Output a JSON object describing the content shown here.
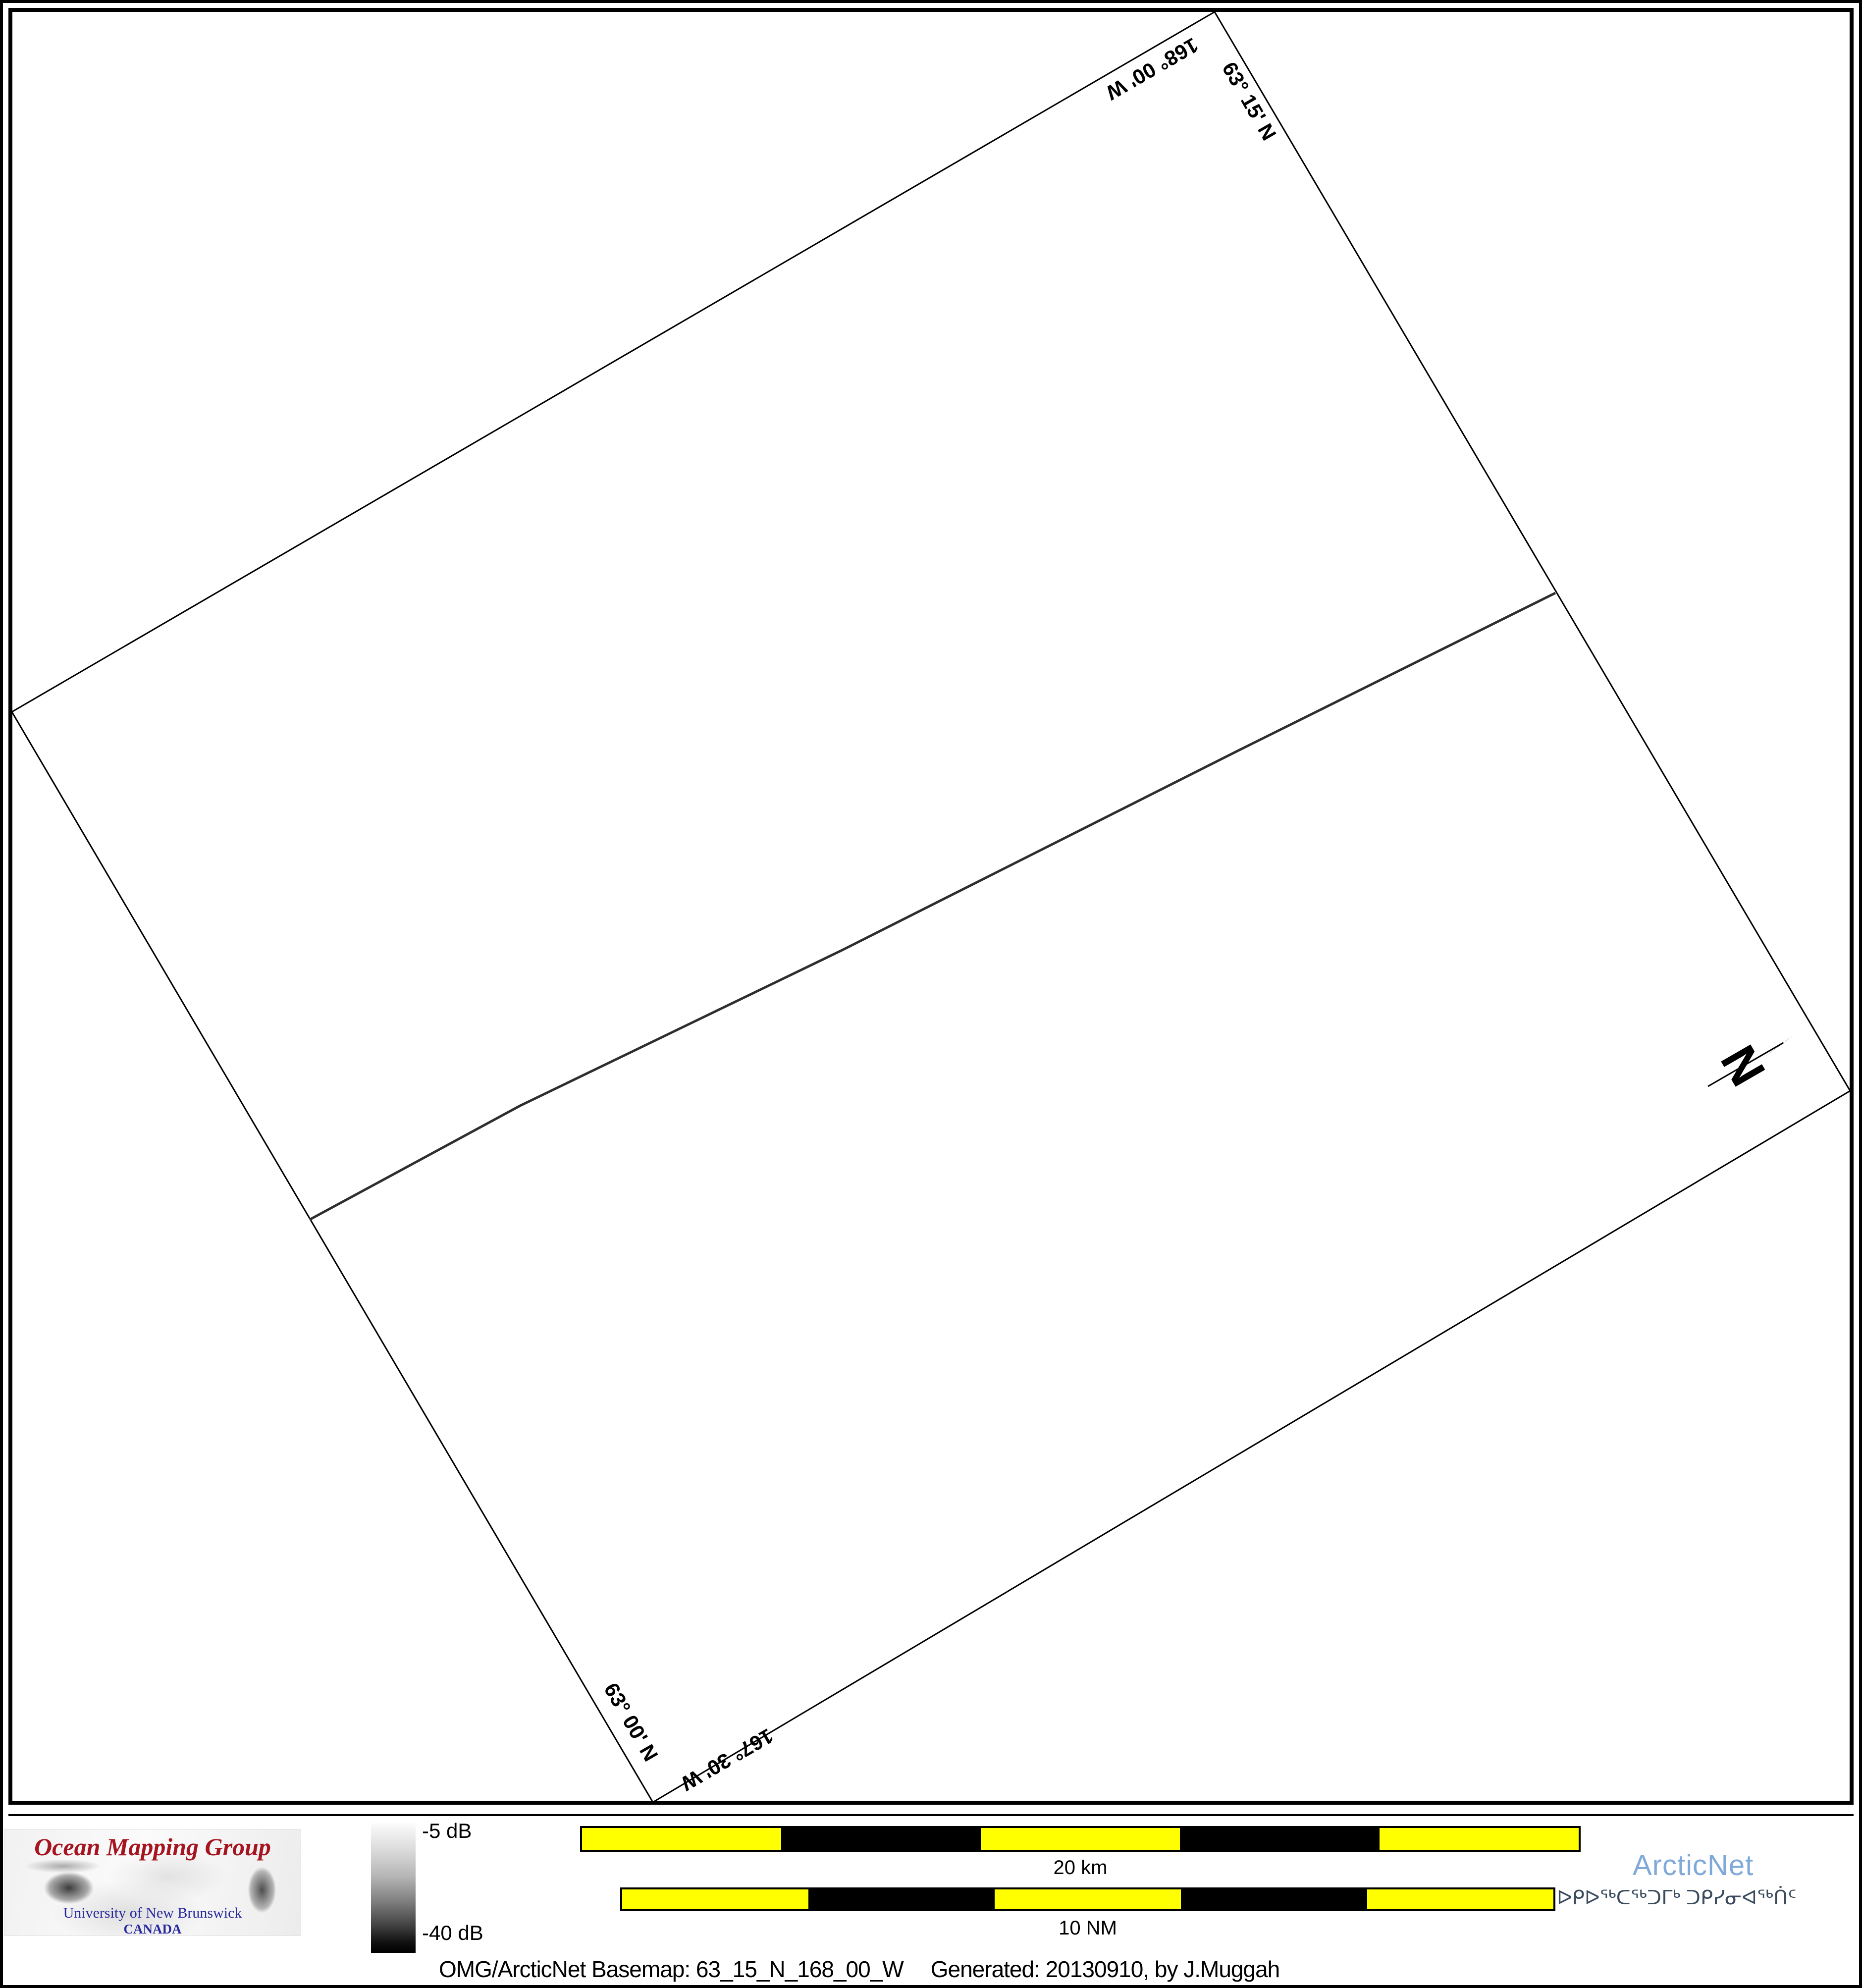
{
  "map": {
    "corner_labels": {
      "top_lat": "63° 15' N",
      "top_lon": "168° 00' W",
      "bottom_lat": "63° 00' N",
      "bottom_lon": "167° 30' W"
    },
    "north_arrow_label": "N",
    "geometry": {
      "frame_polygon_points": "2452,24 3735,2202 1318,3638 24,1437",
      "track_polyline_points": "625,2462 1050,2232 1700,1918 2500,1515 3140,1197",
      "track_color": "#2e2e2e"
    }
  },
  "legend": {
    "omg_logo": {
      "title": "Ocean Mapping Group",
      "subtitle1": "University of New Brunswick",
      "subtitle2": "CANADA",
      "title_color": "#a51520",
      "subtitle_color": "#28289e"
    },
    "colorbar": {
      "top_label": "-5 dB",
      "bottom_label": "-40 dB",
      "top_color": "#fcfcfc",
      "bottom_color": "#000000"
    },
    "scale_bars": {
      "km_label": "20 km",
      "nm_label": "10 NM",
      "yellow": "#ffff00",
      "black": "#000000"
    },
    "arcticnet": {
      "name": "ArcticNet",
      "name_color": "#7fa9d9",
      "inuktitut": "ᐅᑭᐅᖅᑕᖅᑐᒥᒃ ᑐᑭᓯᓂᐊᖅᑏᑦ",
      "inuktitut_color": "#3b4b5e"
    },
    "caption": {
      "basemap": "OMG/ArcticNet Basemap: 63_15_N_168_00_W",
      "generated": "Generated: 20130910, by J.Muggah"
    }
  }
}
